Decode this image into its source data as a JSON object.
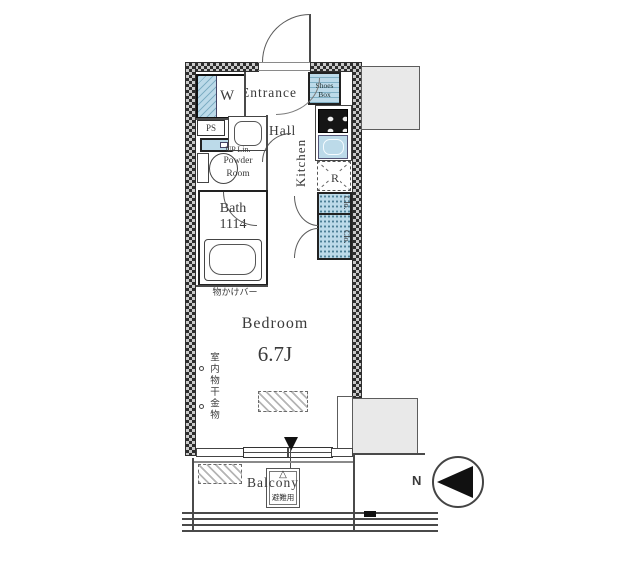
{
  "rooms": {
    "entrance": {
      "label": "Entrance"
    },
    "hall": {
      "label": "Hall"
    },
    "kitchen": {
      "label": "Kitchen"
    },
    "powder_room": {
      "line1": "UP Lin.",
      "line2": "Powder",
      "line3": "Room"
    },
    "bath": {
      "label": "Bath",
      "size": "1114"
    },
    "bedroom": {
      "label": "Bedroom",
      "size": "6.7J"
    },
    "balcony": {
      "label": "Balcony"
    }
  },
  "fixtures": {
    "washer_label": "W",
    "pipe_space_label": "PS",
    "fridge_label": "R",
    "shoes_box": {
      "line1": "Shoes",
      "line2": "Box"
    },
    "closet_upper_label": "Clo.",
    "closet_lower_label": "Clo."
  },
  "annotations": {
    "coat_hanger_bar": "物かけバー",
    "indoor_laundry_hardware": "室内物干金物",
    "evacuation_hatch": "避難用",
    "evacuation_triangle": "△",
    "north_label": "N"
  },
  "colors": {
    "fixture_blue": "#bcdae9",
    "wall_checker_dark": "#2e2e2e",
    "wall_checker_light": "#c9c9c9",
    "gray_area_fill": "#e9e9e9",
    "line": "#444444"
  }
}
